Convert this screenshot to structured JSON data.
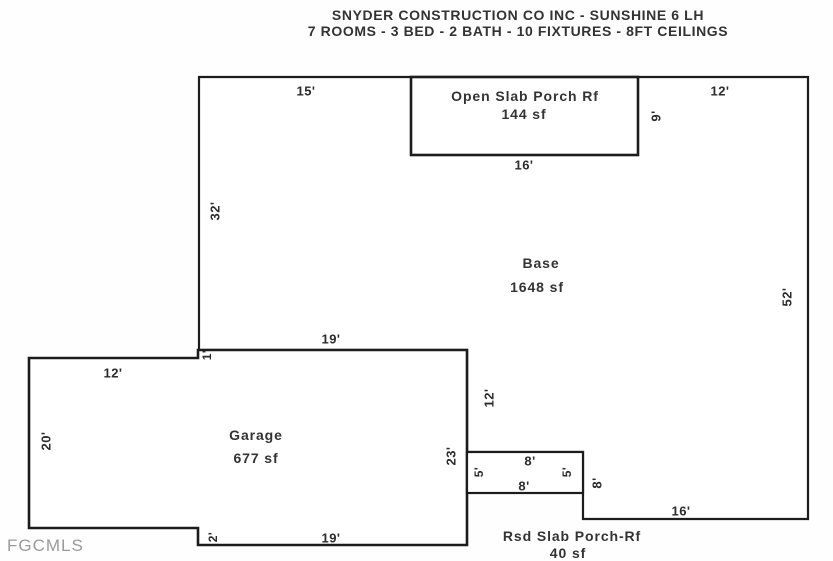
{
  "header": {
    "line1": "SNYDER CONSTRUCTION CO INC - SUNSHINE 6 LH",
    "line2": "7 ROOMS - 3 BED - 2 BATH - 10 FIXTURES - 8FT CEILINGS"
  },
  "watermark": "FGCMLS",
  "rooms": {
    "base": {
      "name": "Base",
      "area": "1648 sf"
    },
    "open_porch": {
      "name": "Open Slab Porch Rf",
      "area": "144 sf"
    },
    "garage": {
      "name": "Garage",
      "area": "677 sf"
    },
    "rsd_porch": {
      "name": "Rsd Slab Porch-Rf",
      "area": "40 sf"
    }
  },
  "dims": {
    "base_top_left": "15'",
    "base_top_right": "12'",
    "open_porch_bottom": "16'",
    "open_porch_right": "9'",
    "base_left": "32'",
    "base_right": "52'",
    "garage_inner_top": "19'",
    "base_left_jog": "1'",
    "garage_top_left": "12'",
    "base_garage_wall": "12'",
    "garage_left": "20'",
    "garage_right": "23'",
    "rsd_porch_top": "8'",
    "rsd_porch_left": "5'",
    "rsd_porch_right": "5'",
    "rsd_porch_bottom": "8'",
    "base_step_right": "8'",
    "base_bottom": "16'",
    "garage_bottom_jog": "2'",
    "garage_bottom": "19'"
  },
  "colors": {
    "line": "#1c1c1c",
    "text": "#2c2c2c",
    "watermark": "#9a9a9a",
    "background": "#ffffff"
  }
}
